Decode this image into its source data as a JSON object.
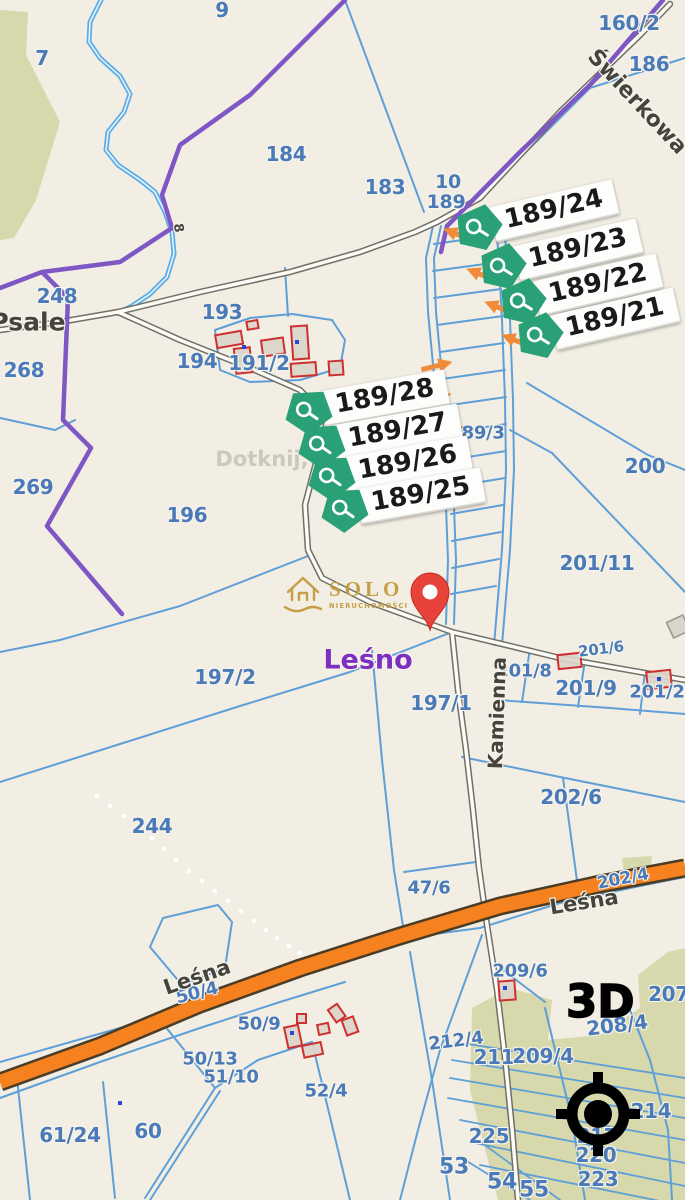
{
  "map": {
    "background": "#f2eee3",
    "hint_text": "Dotknij,",
    "place_labels": {
      "lesno": "Leśno"
    },
    "street_labels": {
      "swierkowa": "Świerkowa",
      "psale": "Psale",
      "kamienna": "Kamienna",
      "lesna_left": "Leśna",
      "lesna_right": "Leśna",
      "river_8": "8"
    },
    "parcel_labels": [
      {
        "text": "9"
      },
      {
        "text": "7"
      },
      {
        "text": "184"
      },
      {
        "text": "183"
      },
      {
        "text": "10"
      },
      {
        "text": "189"
      },
      {
        "text": "160/2"
      },
      {
        "text": "186"
      },
      {
        "text": "248"
      },
      {
        "text": "268"
      },
      {
        "text": "193"
      },
      {
        "text": "194"
      },
      {
        "text": "191/2"
      },
      {
        "text": "269"
      },
      {
        "text": "196"
      },
      {
        "text": "189/3"
      },
      {
        "text": "200"
      },
      {
        "text": "201/11"
      },
      {
        "text": "197/2"
      },
      {
        "text": "197/1"
      },
      {
        "text": "201/8"
      },
      {
        "text": "201/6"
      },
      {
        "text": "201/9"
      },
      {
        "text": "201/2"
      },
      {
        "text": "202/6"
      },
      {
        "text": "244"
      },
      {
        "text": "47/6"
      },
      {
        "text": "202/4"
      },
      {
        "text": "209/6"
      },
      {
        "text": "207/"
      },
      {
        "text": "50/4"
      },
      {
        "text": "50/9"
      },
      {
        "text": "208/4"
      },
      {
        "text": "50/13"
      },
      {
        "text": "51/10"
      },
      {
        "text": "212/4"
      },
      {
        "text": "211"
      },
      {
        "text": "209/4"
      },
      {
        "text": "52/4"
      },
      {
        "text": "61/24"
      },
      {
        "text": "60"
      },
      {
        "text": "225"
      },
      {
        "text": "53"
      },
      {
        "text": "54"
      },
      {
        "text": "55"
      },
      {
        "text": "214"
      },
      {
        "text": "217"
      },
      {
        "text": "220"
      },
      {
        "text": "223"
      }
    ]
  },
  "badges": {
    "group1": [
      {
        "label": "189/24"
      },
      {
        "label": "189/23"
      },
      {
        "label": "189/22"
      },
      {
        "label": "189/21"
      }
    ],
    "group2": [
      {
        "label": "189/28"
      },
      {
        "label": "189/27"
      },
      {
        "label": "189/26"
      },
      {
        "label": "189/25"
      }
    ]
  },
  "watermark": {
    "brand": "SOLO",
    "subtitle": "NIERUCHOMOŚCI"
  },
  "controls": {
    "view_3d_label": "3D"
  },
  "colors": {
    "badge_green": "#2aa077",
    "arrow_orange": "#ef8b3a",
    "road_orange": "#f5821f",
    "pin_red": "#e8433a",
    "parcel_text": "#4a7ab8",
    "boundary_purple": "#7e57c5",
    "place_purple": "#7d2fc0"
  }
}
